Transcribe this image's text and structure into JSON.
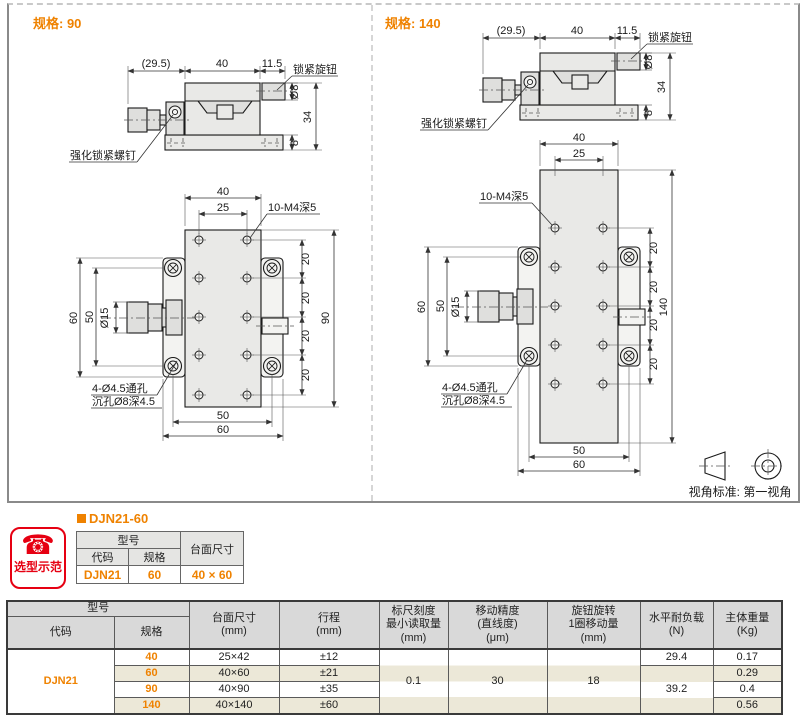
{
  "accent": {
    "orange": "#ef8200",
    "red": "#e60012"
  },
  "panel": {
    "left": {
      "spec_label": "规格: 90",
      "side": {
        "dim_len": "(29.5)",
        "dim_width": "40",
        "dim_knob": "11.5",
        "lock_knob_label": "锁紧旋钮",
        "dim_dia": "Ø8",
        "dim_height": "34",
        "dim_base": "8",
        "screw_label": "强化锁紧螺钉"
      },
      "front": {
        "dim_width": "40",
        "dim_inner": "25",
        "holes_label": "10-M4深5",
        "dim_seg_1": "20",
        "dim_seg_2": "20",
        "dim_seg_3": "20",
        "dim_seg_4": "20",
        "dim_length": "90",
        "dim_left_outer": "60",
        "dim_left_inner": "50",
        "dim_knob_dia": "Ø15",
        "thru_label": "4-Ø4.5通孔",
        "cbore_label": "沉孔Ø8深4.5",
        "dim_bot_inner": "50",
        "dim_bot_outer": "60"
      }
    },
    "right": {
      "spec_label": "规格: 140",
      "side": {
        "dim_len": "(29.5)",
        "dim_width": "40",
        "dim_knob": "11.5",
        "lock_knob_label": "锁紧旋钮",
        "dim_dia": "Ø8",
        "dim_height": "34",
        "dim_base": "8",
        "screw_label": "强化锁紧螺钉"
      },
      "front": {
        "dim_width": "40",
        "dim_inner": "25",
        "holes_label": "10-M4深5",
        "dim_seg_1": "20",
        "dim_seg_2": "20",
        "dim_seg_3": "20",
        "dim_seg_4": "20",
        "dim_length": "140",
        "dim_left_outer": "60",
        "dim_left_inner": "50",
        "dim_knob_dia": "Ø15",
        "thru_label": "4-Ø4.5通孔",
        "cbore_label": "沉孔Ø8深4.5",
        "dim_bot_inner": "50",
        "dim_bot_outer": "60"
      }
    },
    "view_note": "视角标准: 第一视角"
  },
  "example": {
    "badge_label": "选型示范",
    "phone_icon": "☎",
    "heading": "DJN21-60",
    "table": {
      "h_model": "型号",
      "h_code": "代码",
      "h_spec": "规格",
      "h_size": "台面尺寸",
      "code": "DJN21",
      "spec": "60",
      "size": "40 × 60"
    }
  },
  "spec_table": {
    "h_model": "型号",
    "h_code": "代码",
    "h_spec": "规格",
    "h_size": "台面尺寸\n(mm)",
    "h_travel": "行程\n(mm)",
    "h_scale": "标尺刻度\n最小读取量\n(mm)",
    "h_accuracy": "移动精度\n(直线度)\n(μm)",
    "h_knob": "旋钮旋转\n1圈移动量\n(mm)",
    "h_load": "水平耐负载\n(N)",
    "h_weight": "主体重量\n(Kg)",
    "code": "DJN21",
    "rows": [
      {
        "spec": "40",
        "size": "25×42",
        "travel": "±12",
        "weight": "0.17"
      },
      {
        "spec": "60",
        "size": "40×60",
        "travel": "±21",
        "weight": "0.29"
      },
      {
        "spec": "90",
        "size": "40×90",
        "travel": "±35",
        "weight": "0.4"
      },
      {
        "spec": "140",
        "size": "40×140",
        "travel": "±60",
        "weight": "0.56"
      }
    ],
    "scale_value": "0.1",
    "accuracy_value": "30",
    "knob_value": "18",
    "load_row1": "29.4",
    "load_merged": "39.2"
  }
}
